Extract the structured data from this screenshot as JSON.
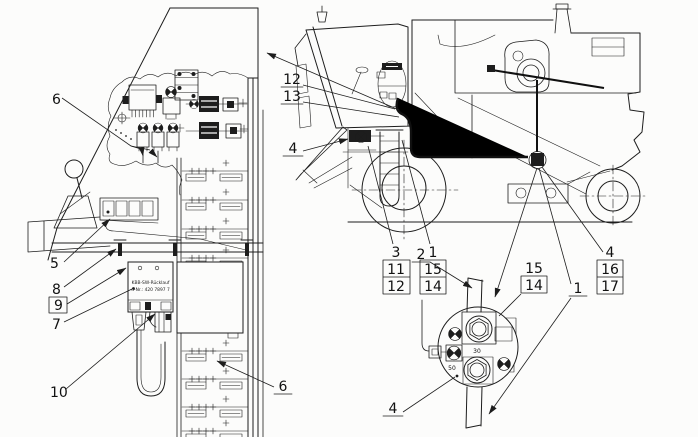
{
  "figure": {
    "type": "technical-parts-diagram",
    "subject": "Combine harvester electrical installation: cab console detail, side view with wiring harness, and starter-solenoid terminal detail"
  },
  "console_view": {
    "callouts": {
      "c6_top": "6",
      "c5": "5",
      "c8": "8",
      "c9": "9",
      "c7": "7",
      "c10": "10",
      "c6_bottom": "6"
    },
    "relay_box_label": {
      "line1": "KBB-SW-Rücklauf",
      "line2": "d-Nr.: 420 7897 7"
    }
  },
  "machine_view": {
    "callouts": {
      "c12": "12",
      "c13": "13",
      "c4_header": "4",
      "c2": "2",
      "c1": "1",
      "c4_bottom": "4",
      "stack_front_left": [
        "3",
        "11",
        "12"
      ],
      "stack_front_right": [
        "1",
        "15",
        "14"
      ],
      "stack_solenoid": [
        "15",
        "14"
      ],
      "stack_rear": [
        "4",
        "16",
        "17"
      ]
    }
  },
  "solenoid_detail": {
    "terminal_labels": {
      "t30": "30",
      "t50": "50"
    }
  }
}
